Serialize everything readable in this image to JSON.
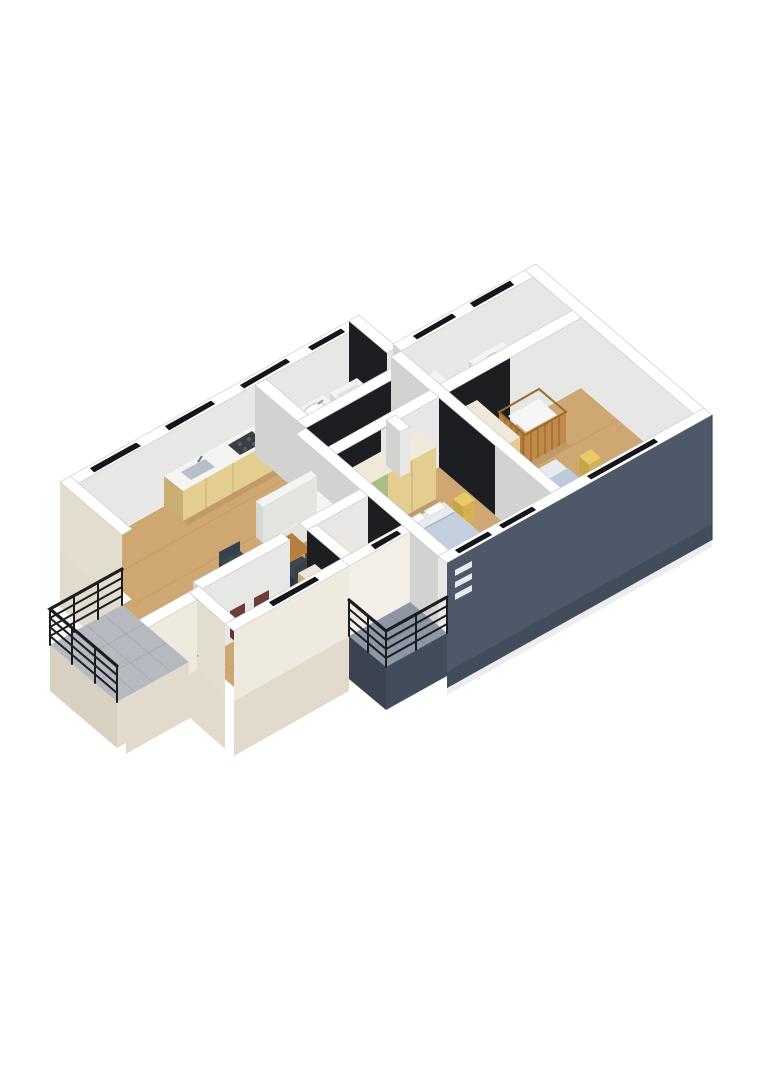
{
  "scene": {
    "title": "3D isometric floor plan rendering of an apartment",
    "type": "architectural-3d-floor-plan",
    "background": "#ffffff",
    "projection": "isometric",
    "text_visible": []
  },
  "palette": {
    "wall_cut_top": "#ffffff",
    "wall_light_face": "#e7e7e5",
    "wall_shadow_face": "#d2d2d0",
    "wall_black_accent": "#1c1e22",
    "window_slit": "#141619",
    "facade_dark_slate": "#4e5869",
    "facade_dark_shadow": "#434c5b",
    "facade_cream": "#efeadf",
    "plinth_cream": "#e2dbcd",
    "floor_wood": "#cfa772",
    "floor_tile": "#c9cdd2",
    "balcony_tile_light": "#b6bac0",
    "balcony_tile_dark": "#8d97a6",
    "furniture_white": "#f4f4f2",
    "furniture_wood": "#b57f3f",
    "wardrobe_tan": "#e3cd90",
    "wardrobe_green": "#a9bd85",
    "bed_blanket_blue": "#c3cfdd",
    "chair_teal": "#3c4750",
    "chair_maroon": "#7c4646",
    "accent_yellow": "#e9c968",
    "railing_black": "#1b1d20"
  },
  "building": {
    "facades": {
      "northwest": "white cut walls with black window slits",
      "southeast": "dark slate wall with vent slits",
      "base": "cream plinth"
    },
    "balconies": [
      {
        "id": "balcony-west",
        "floor": "light gray tile",
        "railing": "black horizontal rails"
      },
      {
        "id": "balcony-south",
        "floor": "dark blue-gray tile",
        "railing": "black horizontal rails"
      }
    ],
    "rooms": [
      {
        "id": "living-kitchen",
        "label": "open living / dining / kitchen",
        "furniture": [
          "white sofa",
          "wood coffee table with plant",
          "two teal armchairs",
          "kitchen counter with sink and cooktop"
        ]
      },
      {
        "id": "bathroom-1",
        "label": "bathroom with vanity sink and bathtub"
      },
      {
        "id": "hallway",
        "label": "entry hall"
      },
      {
        "id": "bathroom-2",
        "label": "bathroom with washing machine and sink"
      },
      {
        "id": "kids-room",
        "label": "kids bedroom",
        "furniture": [
          "tan wardrobe",
          "wooden crib",
          "single bed with blue blanket",
          "yellow pouf"
        ]
      },
      {
        "id": "master-bedroom",
        "label": "master bedroom",
        "furniture": [
          "green and tan wardrobe",
          "double bed with blue blanket",
          "yellow nightstand"
        ]
      },
      {
        "id": "study",
        "label": "study",
        "furniture": [
          "desk",
          "two maroon chairs",
          "green cabinet"
        ]
      },
      {
        "id": "small-room",
        "label": "small room",
        "furniture": [
          "green wardrobe",
          "small bed with yellow pillow"
        ]
      }
    ]
  }
}
